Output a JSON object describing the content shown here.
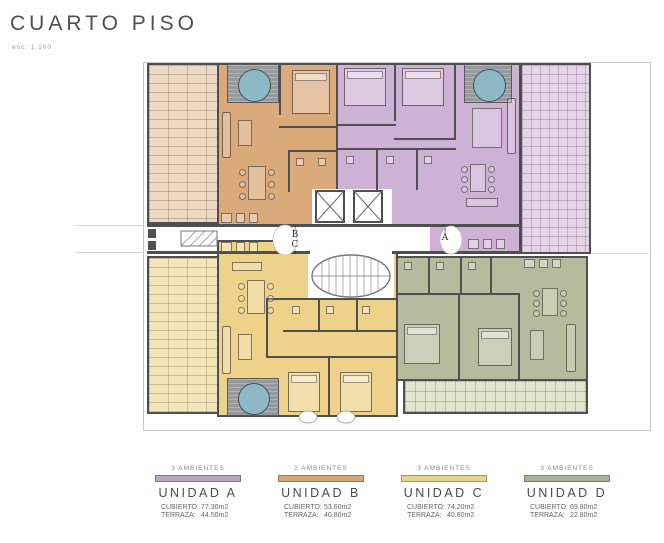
{
  "header": {
    "title": "CUARTO PISO",
    "scale": "esc: 1:100"
  },
  "plan": {
    "markers": {
      "a": "A",
      "b": "B",
      "c": "C",
      "arrow_up": "↑",
      "arrow_down": "↓"
    },
    "colors": {
      "wall": "#4f4f4f",
      "unit_a": "#cdb2d6",
      "unit_b": "#dbaa7b",
      "unit_c": "#eed289",
      "unit_d": "#b3bd9d",
      "terrace_a": "#e5d3e7",
      "terrace_b": "#edd9c2",
      "terrace_c": "#f3e6ba",
      "terrace_d": "#dfe6cd",
      "jacuzzi_water": "#8db8c6",
      "jacuzzi_deck": "#97999c"
    }
  },
  "legend": {
    "units": [
      {
        "ambientes": "3 AMBIENTES",
        "name": "UNIDAD A",
        "cubierto_label": "CUBIERTO:",
        "cubierto_value": "77.30m2",
        "terraza_label": "TERRAZA:",
        "terraza_value": "44.50m2",
        "color": "#b7a4c7"
      },
      {
        "ambientes": "2 AMBIENTES",
        "name": "UNIDAD B",
        "cubierto_label": "CUBIERTO:",
        "cubierto_value": "53.60m2",
        "terraza_label": "TERRAZA:",
        "terraza_value": "40.80m2",
        "color": "#d7a877"
      },
      {
        "ambientes": "3 AMBIENTES",
        "name": "UNIDAD C",
        "cubierto_label": "CUBIERTO:",
        "cubierto_value": "74.20m2",
        "terraza_label": "TERRAZA:",
        "terraza_value": "40.80m2",
        "color": "#e9d28a"
      },
      {
        "ambientes": "3 AMBIENTES",
        "name": "UNIDAD D",
        "cubierto_label": "CUBIERTO:",
        "cubierto_value": "69.80m2",
        "terraza_label": "TERRAZA:",
        "terraza_value": "22.80m2",
        "color": "#a6b493"
      }
    ]
  }
}
